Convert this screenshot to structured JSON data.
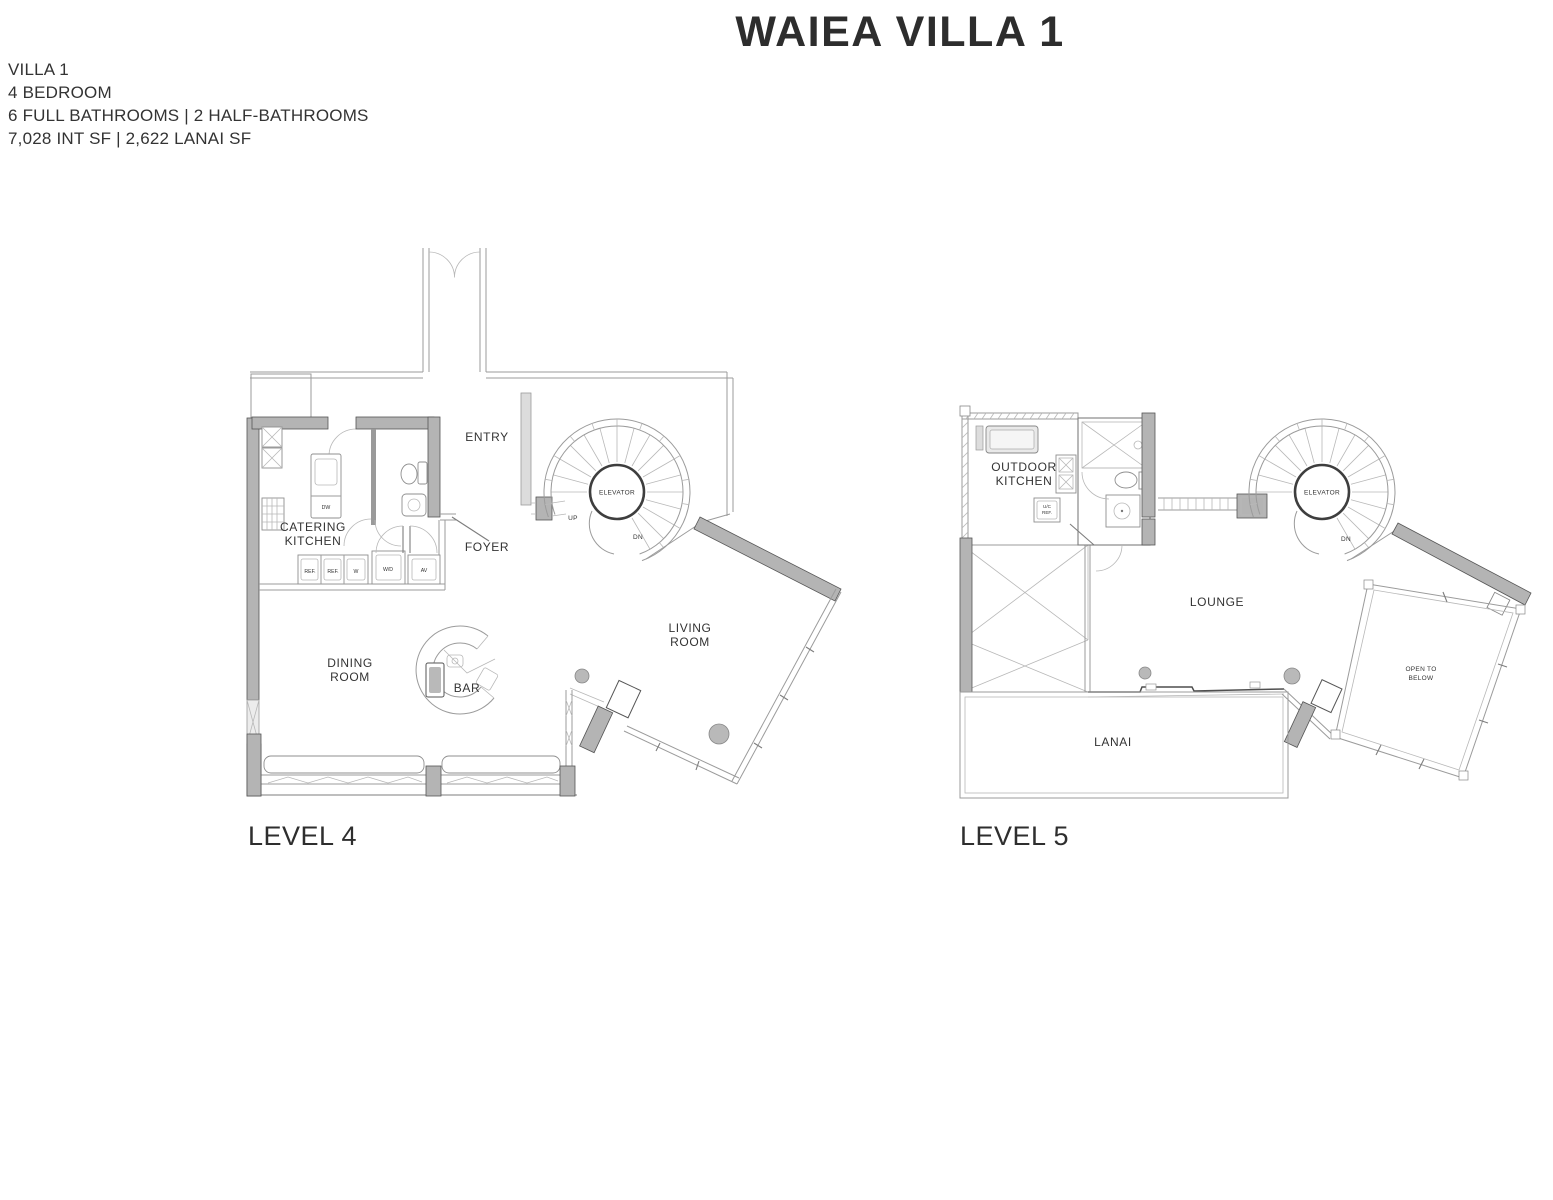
{
  "header": {
    "title": "WAIEA VILLA 1"
  },
  "summary": {
    "lines": [
      "VILLA 1",
      "4 BEDROOM",
      "6 FULL BATHROOMS | 2 HALF-BATHROOMS",
      "7,028 INT SF | 2,622 LANAI SF"
    ]
  },
  "shared": {
    "elevator": "ELEVATOR"
  },
  "level4": {
    "label": "LEVEL 4",
    "rooms": {
      "entry": "ENTRY",
      "catering_kitchen_line1": "CATERING",
      "catering_kitchen_line2": "KITCHEN",
      "foyer": "FOYER",
      "dining_line1": "DINING",
      "dining_line2": "ROOM",
      "bar": "BAR",
      "living_line1": "LIVING",
      "living_line2": "ROOM"
    },
    "annotations": {
      "up": "UP",
      "dn": "DN",
      "dw": "DW",
      "ref1": "REF.",
      "ref2": "REF.",
      "w": "W",
      "wd": "W/D",
      "av": "AV"
    }
  },
  "level5": {
    "label": "LEVEL 5",
    "rooms": {
      "outdoor_kitchen_line1": "OUTDOOR",
      "outdoor_kitchen_line2": "KITCHEN",
      "lounge": "LOUNGE",
      "lanai": "LANAI",
      "open_below_line1": "OPEN TO",
      "open_below_line2": "BELOW"
    },
    "annotations": {
      "dn": "DN",
      "ucref_line1": "U/C",
      "ucref_line2": "REF."
    }
  },
  "colors": {
    "text": "#2f2f2f",
    "wall_fill": "#b4b4b4",
    "line": "#9b9b9b"
  }
}
